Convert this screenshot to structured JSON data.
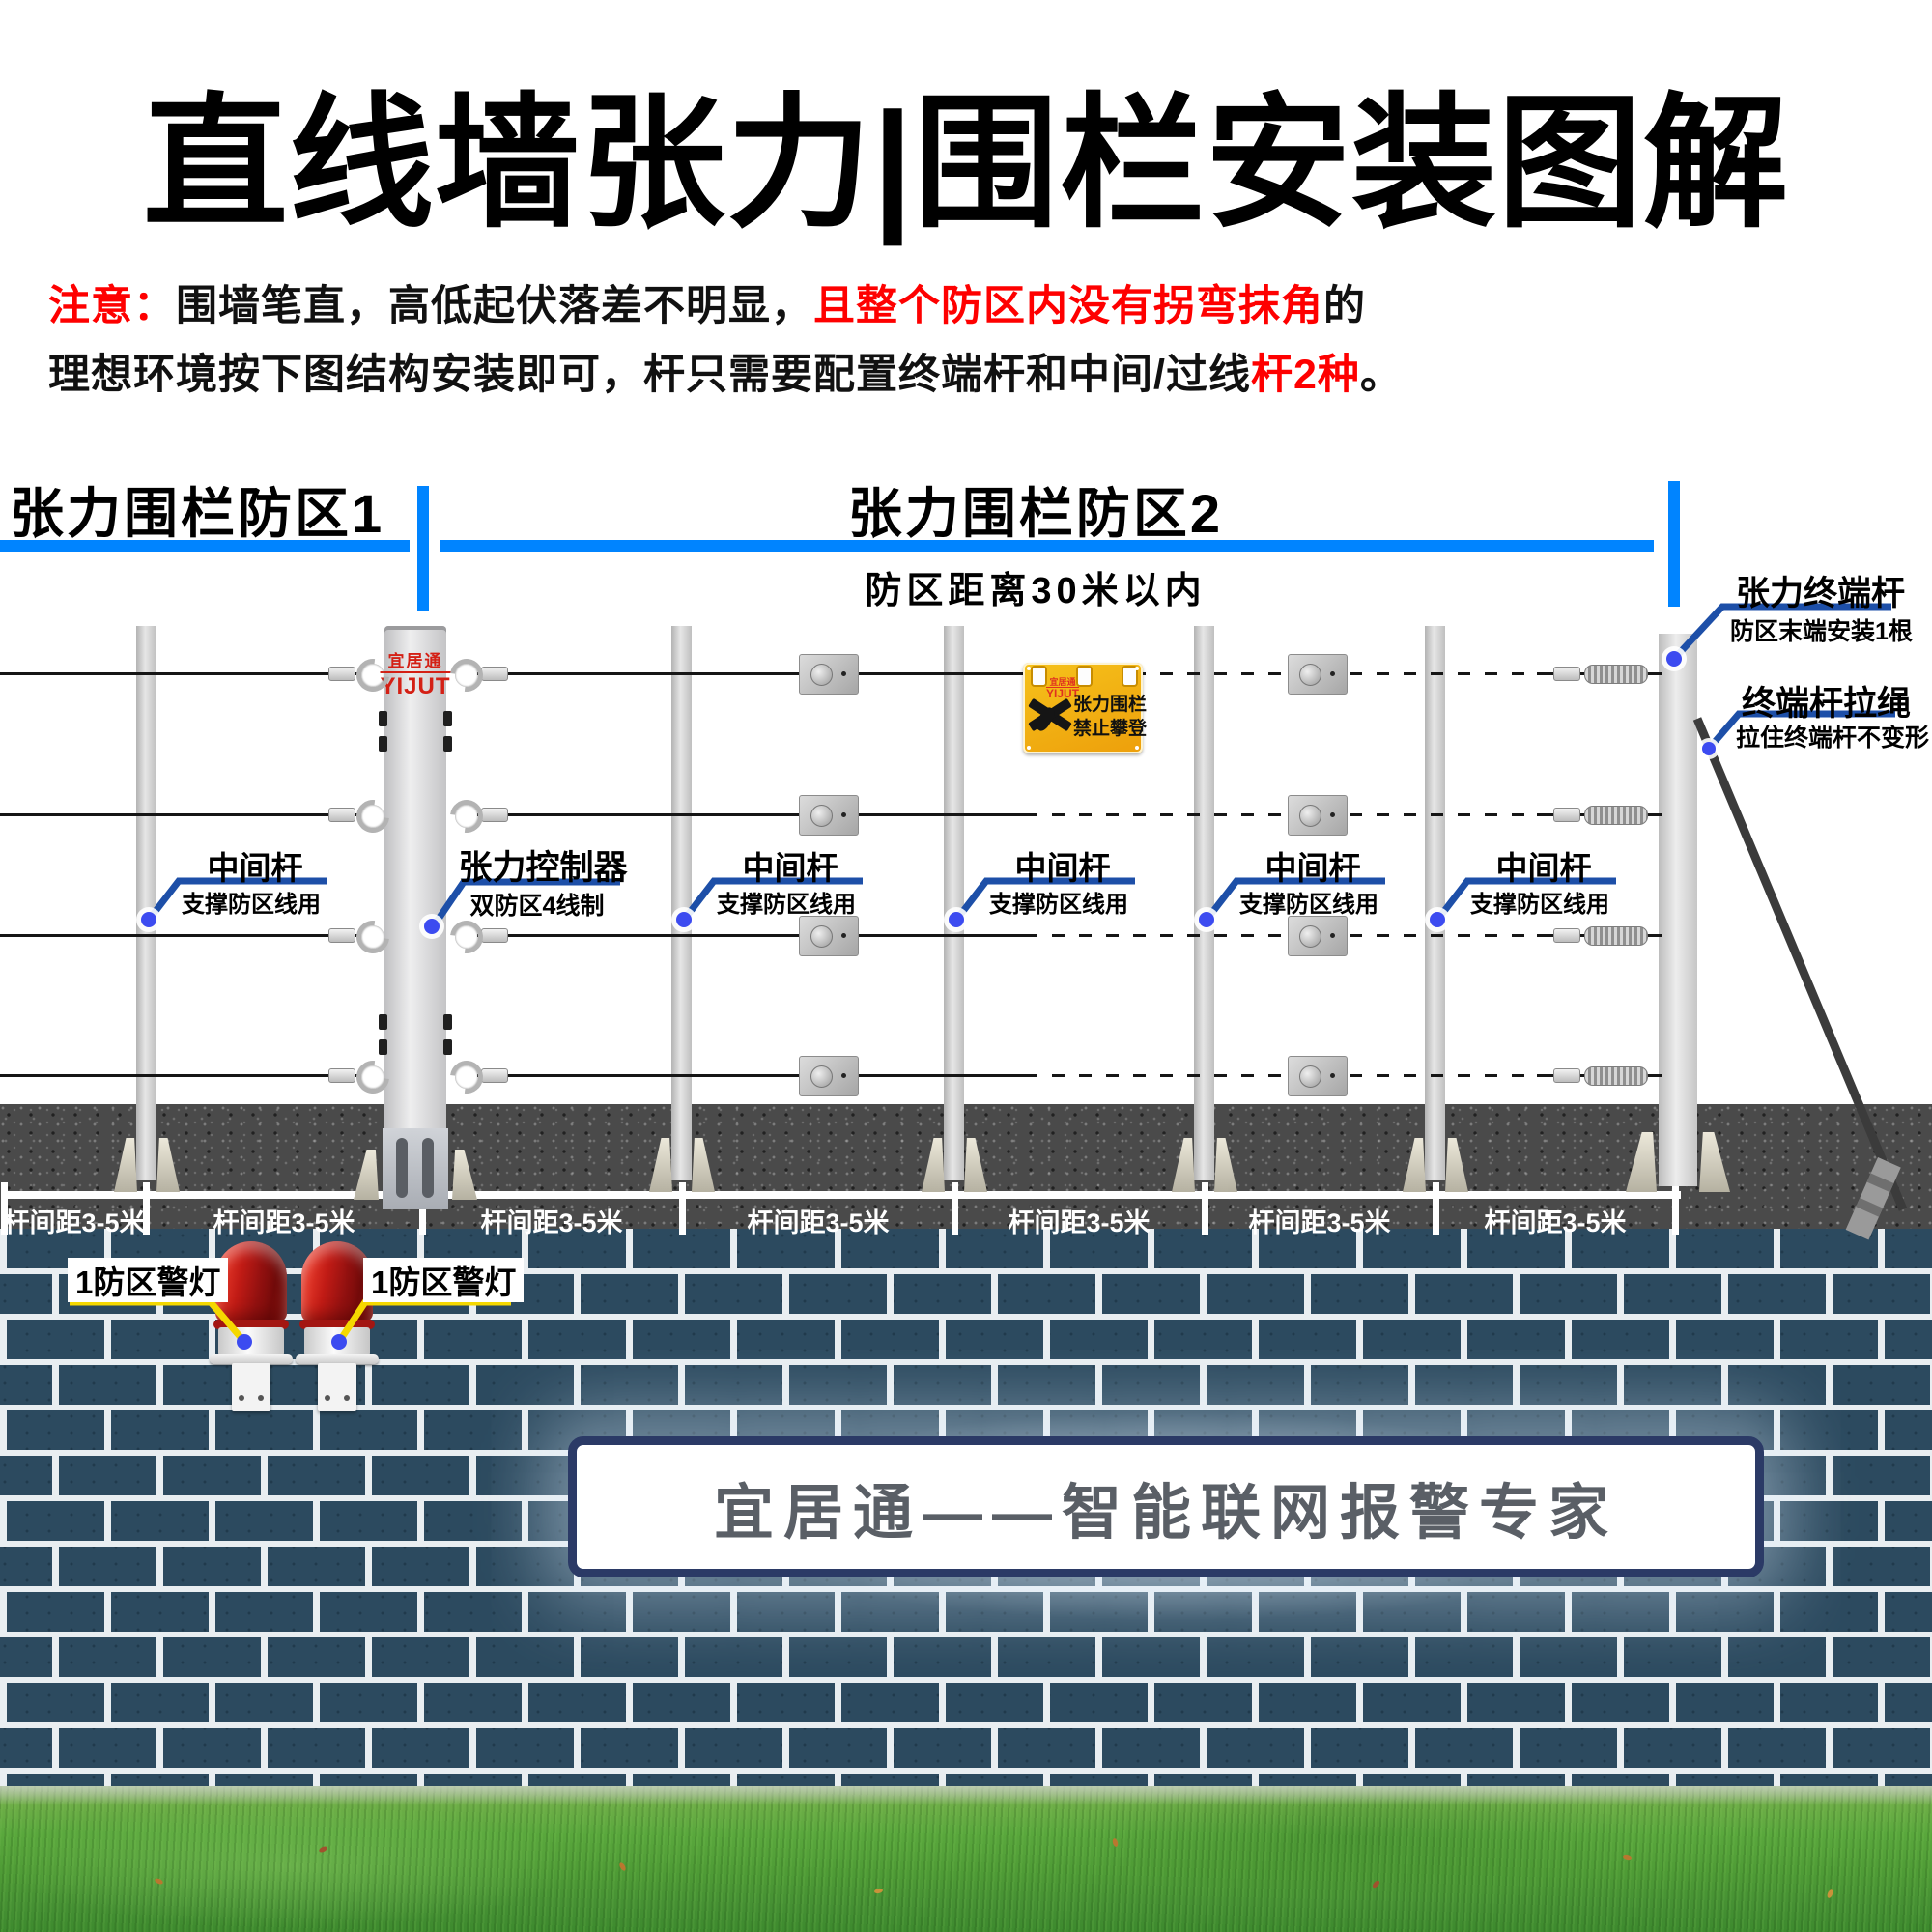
{
  "title": "直线墙张力|围栏安装图解",
  "note": {
    "label": "注意：",
    "l1_black": "围墙笔直，高低起伏落差不明显，",
    "l1_red": "且整个防区内没有拐弯抹角",
    "l1_tail": "的",
    "l2_black": "理想环境按下图结构安装即可，杆只需要配置终端杆和中间/过线",
    "l2_red": "杆2种",
    "l2_tail": "。"
  },
  "zones": {
    "zone1": "张力围栏防区1",
    "zone2": "张力围栏防区2",
    "zone2_sub": "防区距离30米以内"
  },
  "post_labels": {
    "middle_title": "中间杆",
    "middle_sub": "支撑防区线用",
    "controller_title": "张力控制器",
    "controller_sub": "双防区4线制",
    "terminal_title": "张力终端杆",
    "terminal_sub": "防区末端安装1根",
    "rope_title": "终端杆拉绳",
    "rope_sub": "拉住终端杆不变形"
  },
  "ground": {
    "spacing_label": "杆间距3-5米"
  },
  "alarm": {
    "light_label": "1防区警灯"
  },
  "sign": {
    "brand_cn": "宜居通",
    "brand_en": "YIJUT",
    "line1": "张力围栏",
    "line2": "禁止攀登"
  },
  "controller": {
    "brand_cn": "宜居通",
    "brand_en": "YIJUT"
  },
  "slogan": "宜居通——智能联网报警专家",
  "colors": {
    "accent_blue": "#0084ff",
    "leader_blue": "#1d4fa8",
    "dot_blue": "#3c4bf0",
    "note_red": "#fe0000",
    "alarm_yellow": "#f5d800",
    "sign_yellow": "#f0b513",
    "brick": "#2c4a5f",
    "logo_red": "#d42015"
  }
}
